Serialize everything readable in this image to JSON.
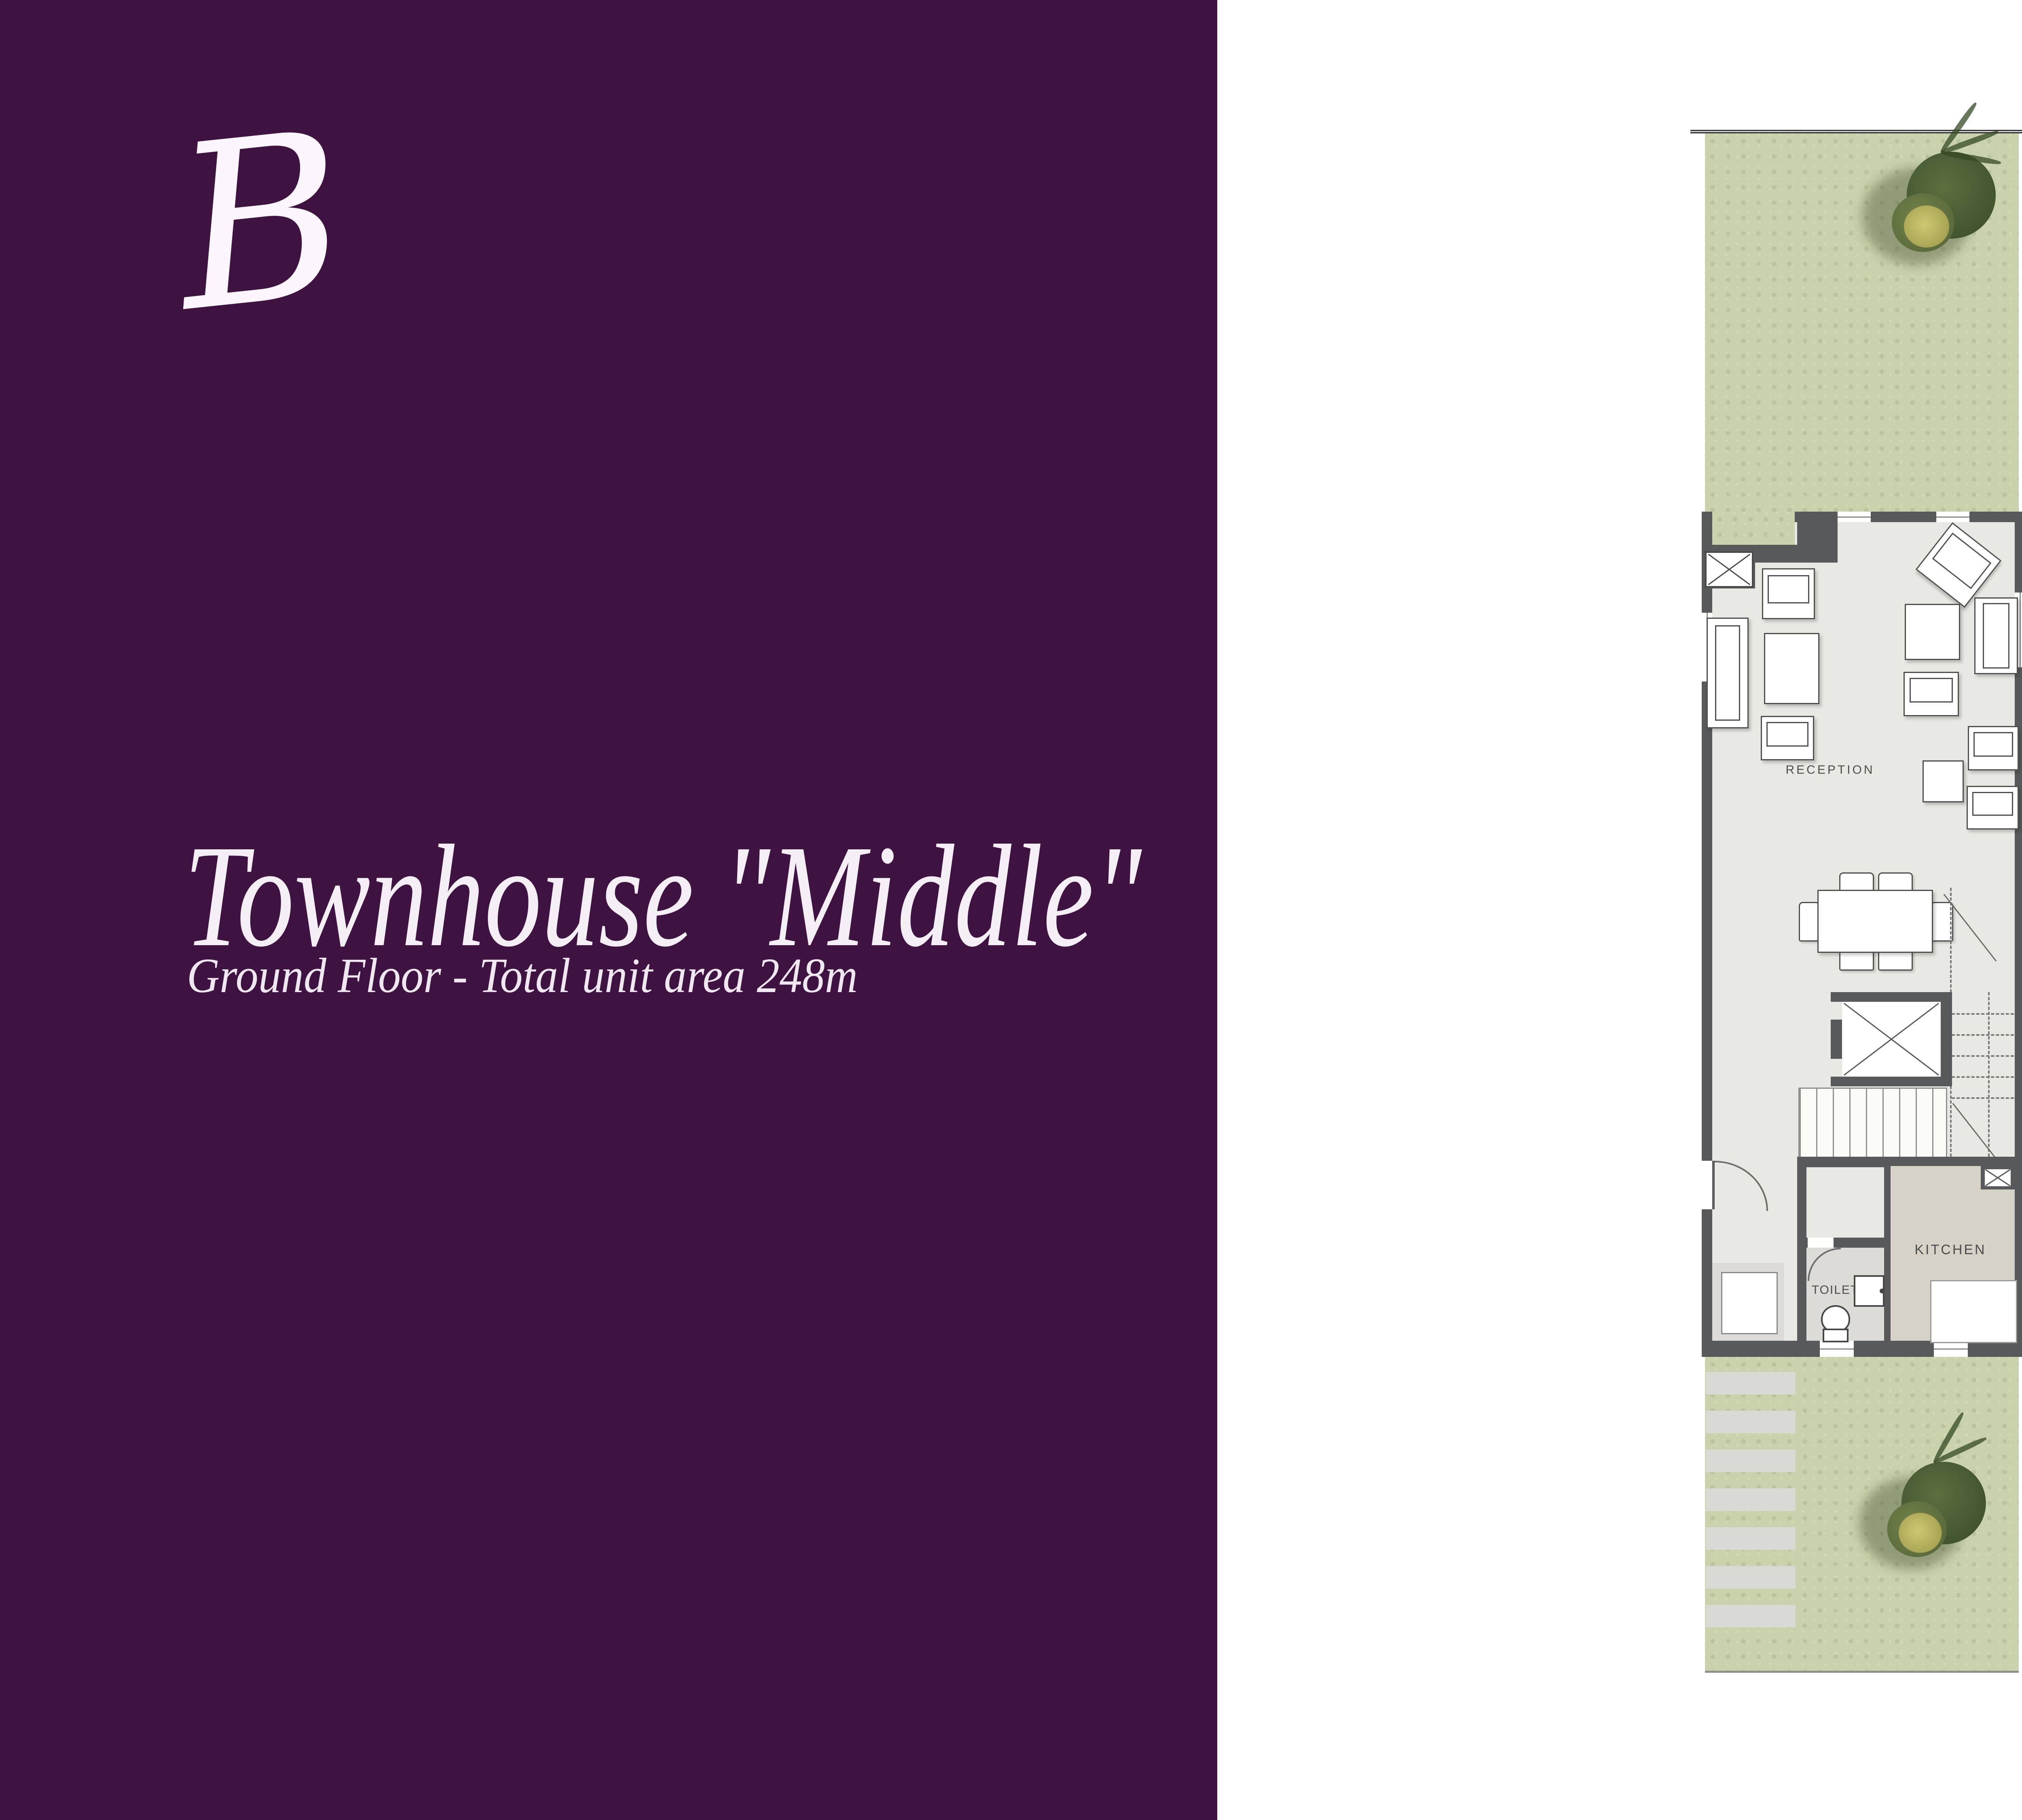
{
  "brand": {
    "logo_letter": "B"
  },
  "panel": {
    "title": "Townhouse \"Middle\"",
    "subtitle": "Ground Floor - Total unit area 248m"
  },
  "plan": {
    "reception_label": "RECEPTION",
    "kitchen_label": "KITCHEN",
    "toilet_label": "TOILET"
  },
  "dimensions_table": {
    "headers": [
      "ROOM",
      "LENGTH",
      "WIDTH"
    ],
    "rows": [
      [
        "RECEPTION",
        "7.30",
        "5.00"
      ],
      [
        "KITCHEN",
        "3.20",
        "2.00"
      ],
      [
        "TOILET",
        "1.90",
        "1.20"
      ]
    ]
  },
  "area_table": {
    "bua_label": "BUA",
    "bua_value": "248",
    "open_roof_label": "Open Roof",
    "open_roof_value": "24.144"
  },
  "colors": {
    "brand_purple": "#3e1241",
    "garden_green": "#c9d2ab",
    "wall_gray": "#58595b",
    "floor_light": "#e9e9e4",
    "kitchen_tan": "#d6d2c7",
    "toilet_gray": "#dcdbd7"
  }
}
